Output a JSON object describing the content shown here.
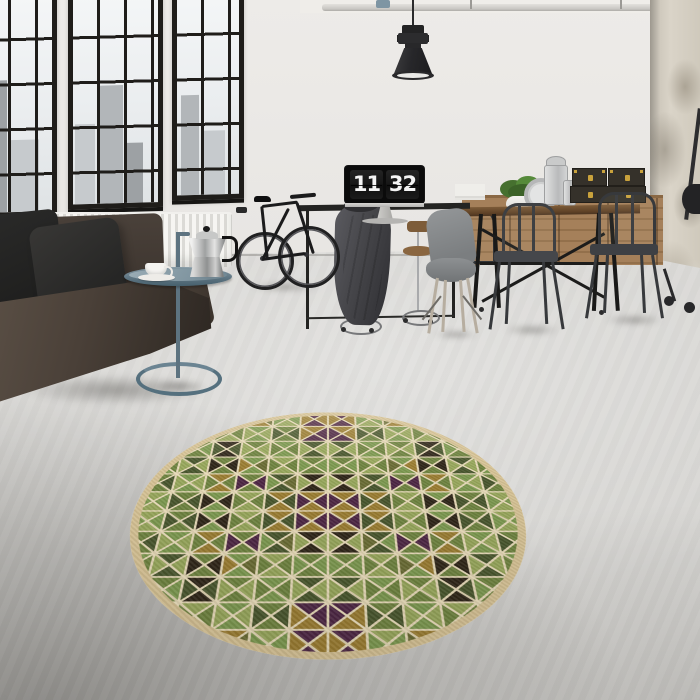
{
  "clock": {
    "hours": "11",
    "minutes": "32"
  },
  "rug": {
    "grid": 12,
    "line_color": "#e9dcba",
    "edge_color": "#d8c496",
    "palette": [
      "#6f8440",
      "#98a85c",
      "#49572e",
      "#a9b578",
      "#7d9a50",
      "#4e2745",
      "#2f2619",
      "#9c7e32",
      "#6b6d35"
    ],
    "quadrant": [
      [
        "4141",
        "1212",
        "0505",
        "2870",
        "1414",
        "5757"
      ],
      [
        "0404",
        "4646",
        "1010",
        "4141",
        "0202",
        "7557"
      ],
      [
        "1515",
        "0404",
        "6262",
        "0101",
        "4040",
        "2121"
      ],
      [
        "4040",
        "2121",
        "0606",
        "4847",
        "1010",
        "0404"
      ],
      [
        "0202",
        "4141",
        "7070",
        "0505",
        "2824",
        "6161"
      ],
      [
        "1414",
        "0202",
        "4646",
        "1010",
        "7272",
        "7575"
      ]
    ]
  },
  "accents": {
    "side_table": "#5d7380",
    "box_latch": "#c9a23c",
    "wall": "#e8e6e3",
    "floor": "#d5d4d1"
  }
}
